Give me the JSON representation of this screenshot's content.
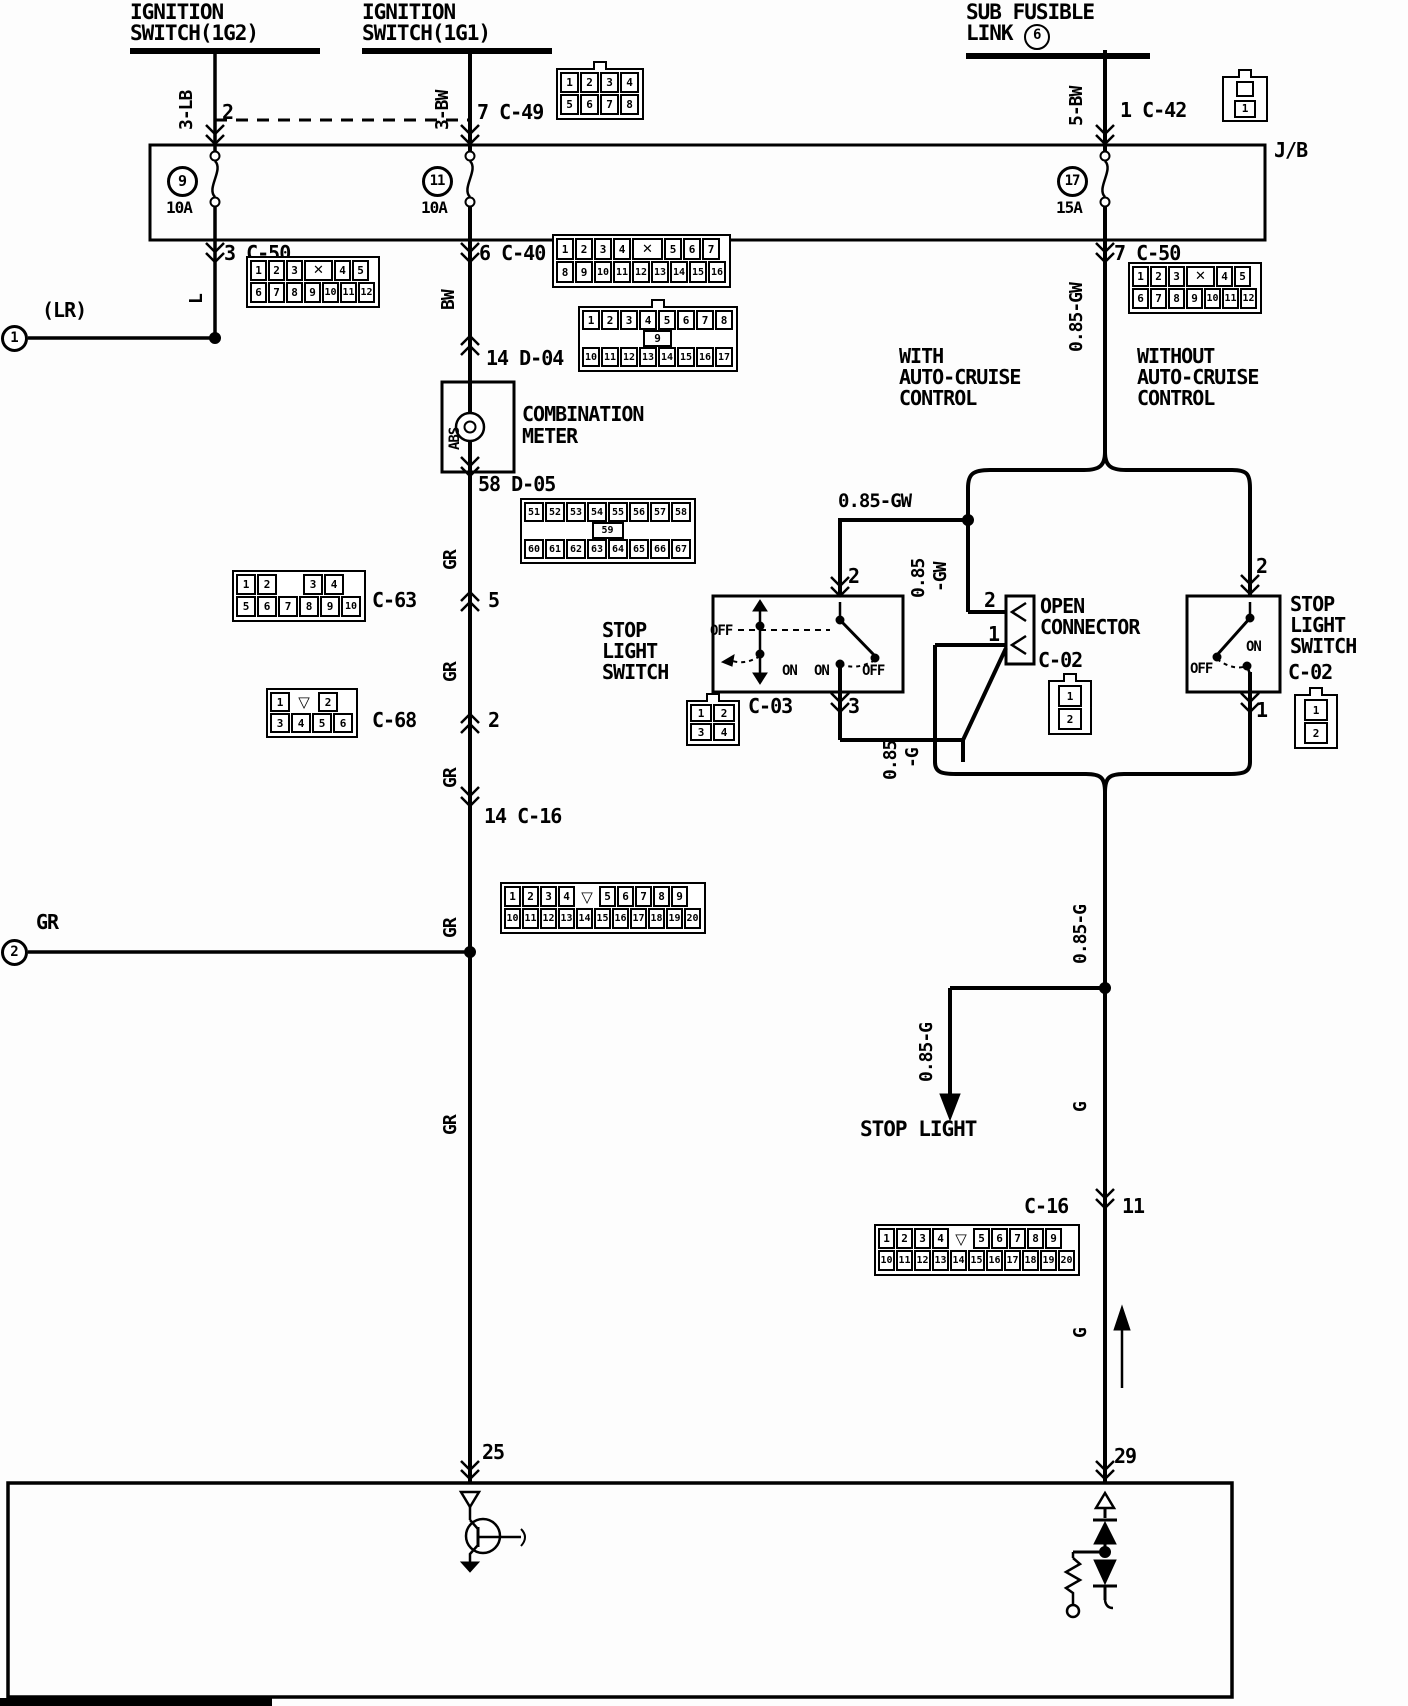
{
  "headers": [
    {
      "id": "ignition-switch-1g2",
      "lines": [
        "IGNITION",
        "SWITCH(1G2)"
      ],
      "x": 130,
      "y": 2,
      "w": 190
    },
    {
      "id": "ignition-switch-1g1",
      "lines": [
        "IGNITION",
        "SWITCH(1G1)"
      ],
      "x": 362,
      "y": 2,
      "w": 190
    },
    {
      "id": "sub-fusible-link",
      "lines": [
        "SUB FUSIBLE",
        "LINK "
      ],
      "circled": "6",
      "x": 966,
      "y": 2,
      "w": 184
    }
  ],
  "circled_refs": [
    {
      "n": "1",
      "x": 14,
      "y": 338,
      "d": 27,
      "fs": 14
    },
    {
      "n": "2",
      "x": 14,
      "y": 952,
      "d": 27,
      "fs": 14
    },
    {
      "n": "9",
      "x": 182,
      "y": 181,
      "d": 31,
      "fs": 15
    },
    {
      "n": "11",
      "x": 437,
      "y": 181,
      "d": 31,
      "fs": 14
    },
    {
      "n": "17",
      "x": 1072,
      "y": 181,
      "d": 31,
      "fs": 14
    }
  ],
  "labels": [
    {
      "t": "2",
      "x": 222,
      "y": 102
    },
    {
      "t": "7 C-49",
      "x": 477,
      "y": 102
    },
    {
      "t": "1 C-42",
      "x": 1120,
      "y": 100
    },
    {
      "t": "J/B",
      "x": 1274,
      "y": 140
    },
    {
      "t": "10A",
      "x": 166,
      "y": 200,
      "s": 16
    },
    {
      "t": "10A",
      "x": 421,
      "y": 200,
      "s": 16
    },
    {
      "t": "15A",
      "x": 1056,
      "y": 200,
      "s": 16
    },
    {
      "t": "3 C-50",
      "x": 224,
      "y": 243
    },
    {
      "t": "6 C-40",
      "x": 479,
      "y": 243
    },
    {
      "t": "7 C-50",
      "x": 1114,
      "y": 243
    },
    {
      "t": "(LR)",
      "x": 42,
      "y": 300
    },
    {
      "t": "14 D-04",
      "x": 486,
      "y": 348
    },
    {
      "t": "COMBINATION",
      "x": 522,
      "y": 404
    },
    {
      "t": "METER",
      "x": 522,
      "y": 426
    },
    {
      "t": "WITH",
      "x": 899,
      "y": 346
    },
    {
      "t": "AUTO-CRUISE",
      "x": 899,
      "y": 367
    },
    {
      "t": "CONTROL",
      "x": 899,
      "y": 388
    },
    {
      "t": "WITHOUT",
      "x": 1137,
      "y": 346
    },
    {
      "t": "AUTO-CRUISE",
      "x": 1137,
      "y": 367
    },
    {
      "t": "CONTROL",
      "x": 1137,
      "y": 388
    },
    {
      "t": "58 D-05",
      "x": 478,
      "y": 474
    },
    {
      "t": "C-63",
      "x": 372,
      "y": 590
    },
    {
      "t": "5",
      "x": 488,
      "y": 590
    },
    {
      "t": "C-68",
      "x": 372,
      "y": 710
    },
    {
      "t": "2",
      "x": 488,
      "y": 710
    },
    {
      "t": "14 C-16",
      "x": 484,
      "y": 806
    },
    {
      "t": "GR",
      "x": 36,
      "y": 912
    },
    {
      "t": "STOP",
      "x": 602,
      "y": 620
    },
    {
      "t": "LIGHT",
      "x": 602,
      "y": 641
    },
    {
      "t": "SWITCH",
      "x": 602,
      "y": 662
    },
    {
      "t": "C-03",
      "x": 748,
      "y": 696
    },
    {
      "t": "OFF",
      "x": 710,
      "y": 624,
      "s": 14
    },
    {
      "t": "ON",
      "x": 782,
      "y": 664,
      "s": 14
    },
    {
      "t": "ON",
      "x": 814,
      "y": 664,
      "s": 14
    },
    {
      "t": "OFF",
      "x": 862,
      "y": 664,
      "s": 14
    },
    {
      "t": "2",
      "x": 848,
      "y": 566
    },
    {
      "t": "3",
      "x": 848,
      "y": 696
    },
    {
      "t": "0.85-GW",
      "x": 838,
      "y": 492,
      "s": 19
    },
    {
      "t": "OPEN",
      "x": 1040,
      "y": 596
    },
    {
      "t": "CONNECTOR",
      "x": 1040,
      "y": 617
    },
    {
      "t": "C-02",
      "x": 1038,
      "y": 650
    },
    {
      "t": "2",
      "x": 984,
      "y": 590
    },
    {
      "t": "1",
      "x": 988,
      "y": 624
    },
    {
      "t": "2",
      "x": 1256,
      "y": 556
    },
    {
      "t": "1",
      "x": 1256,
      "y": 700
    },
    {
      "t": "ON",
      "x": 1246,
      "y": 640,
      "s": 14
    },
    {
      "t": "OFF",
      "x": 1190,
      "y": 662,
      "s": 14
    },
    {
      "t": "STOP",
      "x": 1290,
      "y": 594
    },
    {
      "t": "LIGHT",
      "x": 1290,
      "y": 615
    },
    {
      "t": "SWITCH",
      "x": 1290,
      "y": 636
    },
    {
      "t": "C-02",
      "x": 1288,
      "y": 662
    },
    {
      "t": "STOP LIGHT",
      "x": 860,
      "y": 1118,
      "s": 21
    },
    {
      "t": "C-16",
      "x": 1024,
      "y": 1196
    },
    {
      "t": "11",
      "x": 1122,
      "y": 1196
    },
    {
      "t": "25",
      "x": 482,
      "y": 1442
    },
    {
      "t": "29",
      "x": 1114,
      "y": 1446
    },
    {
      "t": "3-LB",
      "x": 178,
      "y": 130,
      "rot": 1,
      "s": 18
    },
    {
      "t": "3-BW",
      "x": 434,
      "y": 130,
      "rot": 1,
      "s": 18
    },
    {
      "t": "5-BW",
      "x": 1068,
      "y": 126,
      "rot": 1,
      "s": 18
    },
    {
      "t": "L",
      "x": 188,
      "y": 304,
      "rot": 1,
      "s": 18
    },
    {
      "t": "BW",
      "x": 440,
      "y": 310,
      "rot": 1,
      "s": 18
    },
    {
      "t": "0.85-GW",
      "x": 1068,
      "y": 352,
      "rot": 1,
      "s": 18
    },
    {
      "t": "GR",
      "x": 442,
      "y": 570,
      "rot": 1,
      "s": 18
    },
    {
      "t": "GR",
      "x": 442,
      "y": 682,
      "rot": 1,
      "s": 18
    },
    {
      "t": "GR",
      "x": 442,
      "y": 788,
      "rot": 1,
      "s": 18
    },
    {
      "t": "GR",
      "x": 442,
      "y": 938,
      "rot": 1,
      "s": 18
    },
    {
      "t": "GR",
      "x": 442,
      "y": 1135,
      "rot": 1,
      "s": 18
    },
    {
      "t": "0.85",
      "x": 910,
      "y": 598,
      "rot": 1,
      "s": 18
    },
    {
      "t": "-GW",
      "x": 932,
      "y": 592,
      "rot": 1,
      "s": 18
    },
    {
      "t": "0.85",
      "x": 882,
      "y": 780,
      "rot": 1,
      "s": 18
    },
    {
      "t": "-G",
      "x": 904,
      "y": 768,
      "rot": 1,
      "s": 18
    },
    {
      "t": "0.85-G",
      "x": 1072,
      "y": 964,
      "rot": 1,
      "s": 18
    },
    {
      "t": "0.85-G",
      "x": 918,
      "y": 1082,
      "rot": 1,
      "s": 18
    },
    {
      "t": "G",
      "x": 1072,
      "y": 1112,
      "rot": 1,
      "s": 18
    },
    {
      "t": "G",
      "x": 1072,
      "y": 1338,
      "rot": 1,
      "s": 18
    },
    {
      "t": "ABS",
      "x": 448,
      "y": 450,
      "rot": 1,
      "s": 14
    }
  ],
  "connectors": [
    {
      "id": "C-49",
      "x": 556,
      "y": 68,
      "cw": 19,
      "ch": 21,
      "nub": true,
      "rows": [
        [
          "1",
          "2",
          "3",
          "4"
        ],
        [
          "5",
          "6",
          "7",
          "8"
        ]
      ]
    },
    {
      "id": "C-42",
      "x": 1222,
      "y": 76,
      "type": "c42",
      "pin": "1"
    },
    {
      "id": "C-50",
      "x": 246,
      "y": 256,
      "cw": 17,
      "ch": 21,
      "rows": [
        [
          "1",
          "2",
          "3",
          "✕",
          "4",
          "5"
        ],
        [
          "6",
          "7",
          "8",
          "9",
          "10",
          "11",
          "12"
        ]
      ]
    },
    {
      "id": "C-40",
      "x": 552,
      "y": 234,
      "cw": 18,
      "ch": 22,
      "rows": [
        [
          "1",
          "2",
          "3",
          "4",
          "✕",
          "5",
          "6",
          "7"
        ],
        [
          "8",
          "9",
          "10",
          "11",
          "12",
          "13",
          "14",
          "15",
          "16"
        ]
      ]
    },
    {
      "id": "C-50",
      "x": 1128,
      "y": 262,
      "cw": 17,
      "ch": 21,
      "rows": [
        [
          "1",
          "2",
          "3",
          "✕",
          "4",
          "5"
        ],
        [
          "6",
          "7",
          "8",
          "9",
          "10",
          "11",
          "12"
        ]
      ]
    },
    {
      "id": "D-04",
      "x": 578,
      "y": 306,
      "cw": 18,
      "ch": 20,
      "nub": true,
      "rows": [
        [
          "1",
          "2",
          "3",
          "4",
          "5",
          "6",
          "7",
          "8"
        ],
        [
          "9"
        ],
        [
          "10",
          "11",
          "12",
          "13",
          "14",
          "15",
          "16",
          "17"
        ]
      ]
    },
    {
      "id": "D-05",
      "x": 520,
      "y": 498,
      "cw": 20,
      "ch": 20,
      "rows": [
        [
          "51",
          "52",
          "53",
          "54",
          "55",
          "56",
          "57",
          "58"
        ],
        [
          "59"
        ],
        [
          "60",
          "61",
          "62",
          "63",
          "64",
          "65",
          "66",
          "67"
        ]
      ]
    },
    {
      "id": "C-63",
      "x": 232,
      "y": 570,
      "cw": 20,
      "ch": 21,
      "rows": [
        [
          "1",
          "2",
          "",
          "3",
          "4"
        ],
        [
          "5",
          "6",
          "7",
          "8",
          "9",
          "10"
        ]
      ]
    },
    {
      "id": "C-68",
      "x": 266,
      "y": 688,
      "cw": 20,
      "ch": 20,
      "rows": [
        [
          "1",
          "▽",
          "2"
        ],
        [
          "3",
          "4",
          "5",
          "6"
        ]
      ]
    },
    {
      "id": "C-03",
      "x": 686,
      "y": 700,
      "cw": 22,
      "ch": 18,
      "nub": true,
      "rows": [
        [
          "1",
          "2"
        ],
        [
          "3",
          "4"
        ]
      ]
    },
    {
      "id": "C-02",
      "x": 1048,
      "y": 680,
      "type": "c02",
      "pins": [
        "1",
        "2"
      ]
    },
    {
      "id": "C-02",
      "x": 1294,
      "y": 694,
      "type": "c02",
      "pins": [
        "1",
        "2"
      ]
    },
    {
      "id": "C-16",
      "x": 500,
      "y": 882,
      "cw": 17,
      "ch": 21,
      "rows": [
        [
          "1",
          "2",
          "3",
          "4",
          "▽",
          "5",
          "6",
          "7",
          "8",
          "9"
        ],
        [
          "10",
          "11",
          "12",
          "13",
          "14",
          "15",
          "16",
          "17",
          "18",
          "19",
          "20"
        ]
      ]
    },
    {
      "id": "C-16",
      "x": 874,
      "y": 1224,
      "cw": 17,
      "ch": 21,
      "rows": [
        [
          "1",
          "2",
          "3",
          "4",
          "▽",
          "5",
          "6",
          "7",
          "8",
          "9"
        ],
        [
          "10",
          "11",
          "12",
          "13",
          "14",
          "15",
          "16",
          "17",
          "18",
          "19",
          "20"
        ]
      ]
    }
  ]
}
